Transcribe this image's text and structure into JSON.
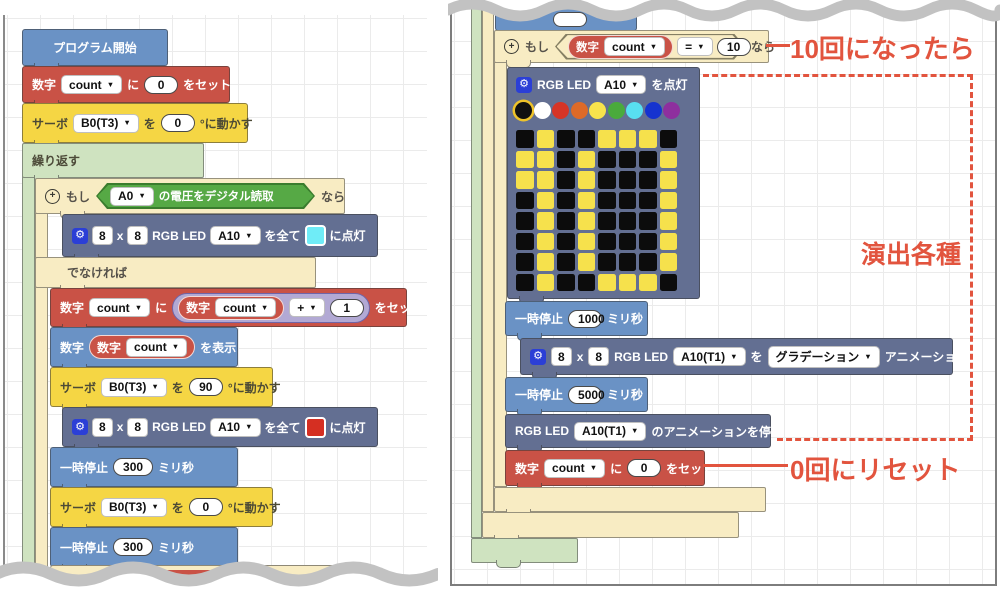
{
  "icons": {
    "caret": "▼",
    "gear": "⚙",
    "plus": "+"
  },
  "annotations": {
    "when_ten": "10回になったら",
    "effects": "演出各種",
    "reset_zero": "0回にリセット",
    "color": "#e2543e"
  },
  "left_panel": {
    "start": {
      "label": "プログラム開始"
    },
    "set_count": {
      "kw": "数字",
      "var": "count",
      "to": "に",
      "value": "0",
      "action": "をセット"
    },
    "servo_init": {
      "kw": "サーボ",
      "port": "B0(T3)",
      "wo": "を",
      "value": "0",
      "unit": "°に動かす"
    },
    "repeat": {
      "label": "繰り返す"
    },
    "if_a": {
      "kw": "もし",
      "port": "A0",
      "cond": "の電圧をデジタル読取",
      "then": "なら",
      "else": "でなければ"
    },
    "led_cyan": {
      "size_a": "8",
      "times": "x",
      "size_b": "8",
      "name": "RGB LED",
      "port": "A10",
      "all": "を全て",
      "action": "に点灯",
      "color": "#6fecf7"
    },
    "increment": {
      "kw": "数字",
      "var": "count",
      "to": "に",
      "inner_kw": "数字",
      "inner_var": "count",
      "op": "+",
      "operand": "1",
      "action": "をセット"
    },
    "display": {
      "kw": "数字",
      "inner_kw": "数字",
      "var": "count",
      "action": "を表示"
    },
    "servo_90": {
      "kw": "サーボ",
      "port": "B0(T3)",
      "wo": "を",
      "value": "90",
      "unit": "°に動かす"
    },
    "led_red": {
      "size_a": "8",
      "times": "x",
      "size_b": "8",
      "name": "RGB LED",
      "port": "A10",
      "all": "を全て",
      "action": "に点灯",
      "color": "#d52f22"
    },
    "pause_1": {
      "kw": "一時停止",
      "value": "300",
      "unit": "ミリ秒"
    },
    "servo_0": {
      "kw": "サーボ",
      "port": "B0(T3)",
      "wo": "を",
      "value": "0",
      "unit": "°に動かす"
    },
    "pause_2": {
      "kw": "一時停止",
      "value": "300",
      "unit": "ミリ秒"
    }
  },
  "right_panel": {
    "if_count": {
      "kw": "もし",
      "num_kw": "数字",
      "var": "count",
      "op": "=",
      "value": "10",
      "then": "なら"
    },
    "led_matrix": {
      "name": "RGB LED",
      "port": "A10",
      "action": "を点灯",
      "palette": [
        "#111111",
        "#ffffff",
        "#d63426",
        "#dd6a28",
        "#f8e34c",
        "#4aaa3c",
        "#58dff0",
        "#1633cf",
        "#8e2f9e"
      ],
      "selected_index": 0,
      "on_color": "#f6e14c",
      "off_color": "#0c0c0c",
      "pattern": [
        [
          0,
          1,
          0,
          0,
          1,
          1,
          1,
          0
        ],
        [
          1,
          1,
          0,
          1,
          0,
          0,
          0,
          1
        ],
        [
          1,
          1,
          0,
          1,
          0,
          0,
          0,
          1
        ],
        [
          0,
          1,
          0,
          1,
          0,
          0,
          0,
          1
        ],
        [
          0,
          1,
          0,
          1,
          0,
          0,
          0,
          1
        ],
        [
          0,
          1,
          0,
          1,
          0,
          0,
          0,
          1
        ],
        [
          0,
          1,
          0,
          1,
          0,
          0,
          0,
          1
        ],
        [
          0,
          1,
          0,
          0,
          1,
          1,
          1,
          0
        ]
      ]
    },
    "pause_1000": {
      "kw": "一時停止",
      "value": "1000",
      "unit": "ミリ秒"
    },
    "animation": {
      "size_a": "8",
      "times": "x",
      "size_b": "8",
      "name": "RGB LED",
      "port": "A10(T1)",
      "wo": "を",
      "mode": "グラデーション",
      "action": "アニメーション"
    },
    "pause_5000": {
      "kw": "一時停止",
      "value": "5000",
      "unit": "ミリ秒"
    },
    "stop_anim": {
      "name": "RGB LED",
      "port": "A10(T1)",
      "action": "のアニメーションを停止"
    },
    "reset": {
      "kw": "数字",
      "var": "count",
      "to": "に",
      "value": "0",
      "action": "をセット"
    }
  }
}
